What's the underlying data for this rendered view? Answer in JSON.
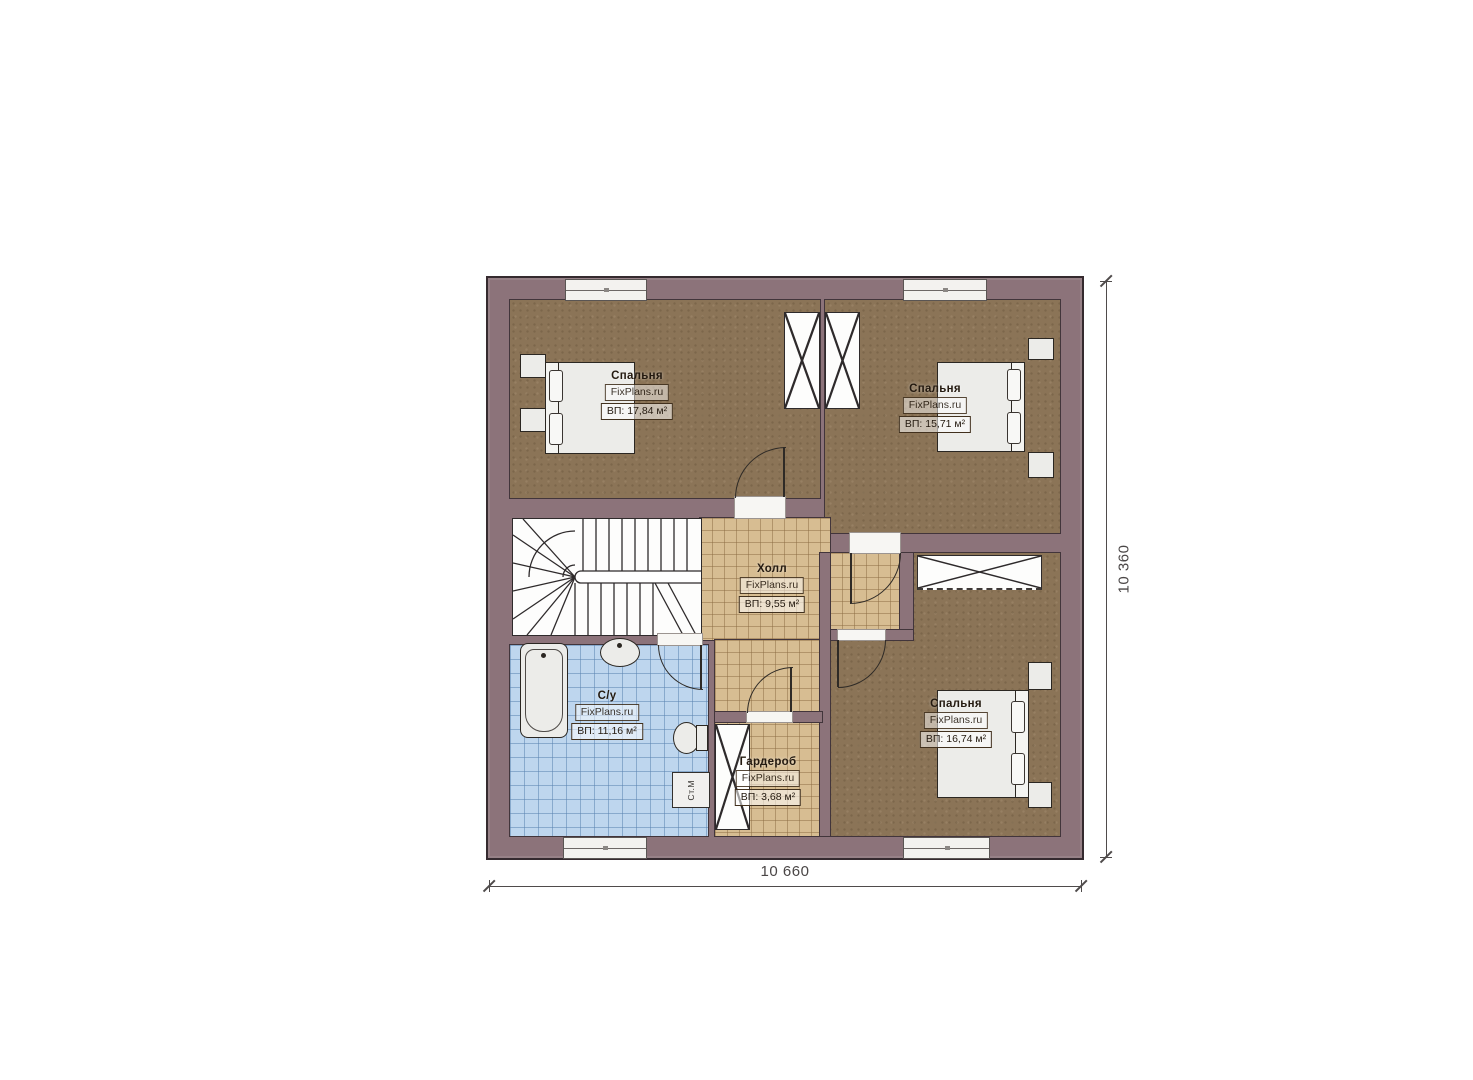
{
  "plan": {
    "brand": "FixPlans.ru",
    "rooms": [
      {
        "name": "Спальня",
        "area": "ВП: 17,84 м²"
      },
      {
        "name": "Спальня",
        "area": "ВП: 15,71 м²"
      },
      {
        "name": "Холл",
        "area": "ВП: 9,55 м²"
      },
      {
        "name": "С/у",
        "area": "ВП: 11,16 м²"
      },
      {
        "name": "Гардероб",
        "area": "ВП: 3,68 м²"
      },
      {
        "name": "Спальня",
        "area": "ВП: 16,74 м²"
      }
    ],
    "labels": {
      "washing_machine": "Ст.М"
    },
    "dimensions": {
      "width": "10 660",
      "height": "10 360"
    },
    "colors": {
      "wall": "#8c737a",
      "wall_outline": "#352a2f",
      "bedroom_floor": "#8b7457",
      "hall_floor": "#d7bd92",
      "bath_floor": "#bed6ee",
      "furniture": "#ecece9",
      "label_text": "#241a10",
      "dimension_text": "#4a4646"
    }
  }
}
